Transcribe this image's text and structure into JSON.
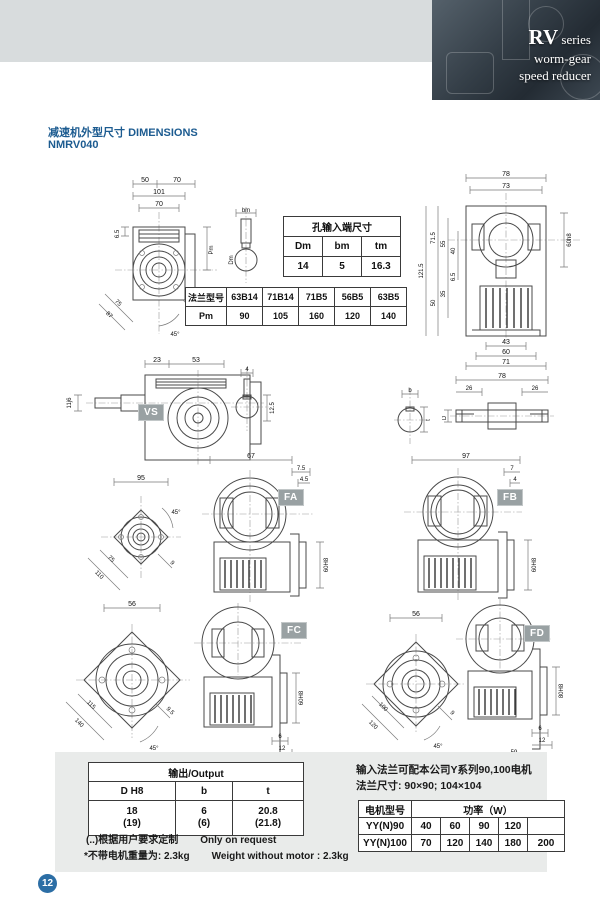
{
  "header": {
    "series": "RV",
    "series_suffix": " series",
    "line2": "worm-gear",
    "line3": "speed reducer"
  },
  "titles": {
    "section_cn": "减速机外型尺寸",
    "section_en": "DIMENSIONS",
    "model": "NMRV040"
  },
  "page": {
    "number": "12"
  },
  "colors": {
    "accent_blue": "#1c5b90",
    "panel_gray": "#e9ebea",
    "label_gray": "#99a1a3"
  },
  "tables": {
    "input_hole": {
      "title": "孔输入端尺寸",
      "headers": [
        "Dm",
        "bm",
        "tm"
      ],
      "values": [
        "14",
        "5",
        "16.3"
      ]
    },
    "flange": {
      "type_label": "法兰型号",
      "types": [
        "63B14",
        "71B14",
        "71B5",
        "56B5",
        "63B5"
      ],
      "pm_label": "Pm",
      "pm_values": [
        "90",
        "105",
        "160",
        "120",
        "140"
      ]
    },
    "output": {
      "title": "输出/Output",
      "headers": [
        "D H8",
        "b",
        "t"
      ],
      "values": [
        "18",
        "6",
        "20.8"
      ],
      "values_alt": [
        "(19)",
        "(6)",
        "(21.8)"
      ]
    },
    "motor": {
      "model_header": "电机型号",
      "power_header": "功率（W）",
      "rows": [
        {
          "model": "YY(N)90",
          "powers": [
            "40",
            "60",
            "90",
            "120",
            ""
          ]
        },
        {
          "model": "YY(N)100",
          "powers": [
            "70",
            "120",
            "140",
            "180",
            "200"
          ]
        }
      ]
    }
  },
  "notes": {
    "custom_cn": "(..)根据用户要求定制",
    "custom_en": "Only on request",
    "weight_cn": "*不带电机重量为: 2.3kg",
    "weight_en": "Weight without motor : 2.3kg"
  },
  "motor_info": {
    "line1": "输入法兰可配本公司Y系列90,100电机",
    "line2": "法兰尺寸: 90×90; 104×104"
  },
  "view_labels": {
    "vs": "VS",
    "fa": "FA",
    "fb": "FB",
    "fc": "FC",
    "fd": "FD"
  },
  "dims": {
    "front": {
      "w_left": "50",
      "w_right": "70",
      "w_total": "101",
      "w_flange": "70",
      "offset": "6.5",
      "pm": "Pm",
      "diag1": "75",
      "diag2": "87",
      "angle": "45°",
      "screw": "M6X8"
    },
    "input_shaft": {
      "top": "bm",
      "dia": "Dm"
    },
    "side": {
      "top_outer": "78",
      "top_inner": "73",
      "h_total": "121.5",
      "h1": "71.5",
      "h2": "55",
      "h3": "40",
      "h4": "50",
      "h5": "35",
      "h6": "6.5",
      "bore": "60h8",
      "b1": "43",
      "b2": "60",
      "b3": "71"
    },
    "vs": {
      "d1": "23",
      "d2": "53",
      "shaft": "11j6"
    },
    "key": {
      "w": "4",
      "h": "12.5"
    },
    "section": {
      "b": "b",
      "t": "t"
    },
    "shaft2": {
      "total": "78",
      "left": "26",
      "right": "26",
      "dia": "D"
    },
    "fa_flange": {
      "top": "95",
      "angle": "45°",
      "diag1": "75",
      "diag2": "110",
      "hole": "9"
    },
    "fa": {
      "top": "67",
      "d1": "7.5",
      "d2": "4.5",
      "bore": "60H8"
    },
    "fb": {
      "top": "97",
      "d1": "7",
      "d2": "4",
      "bore": "60H8"
    },
    "fc_flange": {
      "top": "56",
      "diag1": "115",
      "diag2": "140",
      "hole": "9.5",
      "angle": "45°"
    },
    "fc": {
      "bore": "60H8",
      "d1": "6",
      "d2": "12",
      "bottom": "80"
    },
    "fd_flange": {
      "top": "56",
      "diag1": "100",
      "diag2": "120",
      "hole": "9",
      "angle": "45°"
    },
    "fd": {
      "bore": "80H8",
      "d1": "6",
      "d2": "12",
      "bottom": "59"
    }
  }
}
